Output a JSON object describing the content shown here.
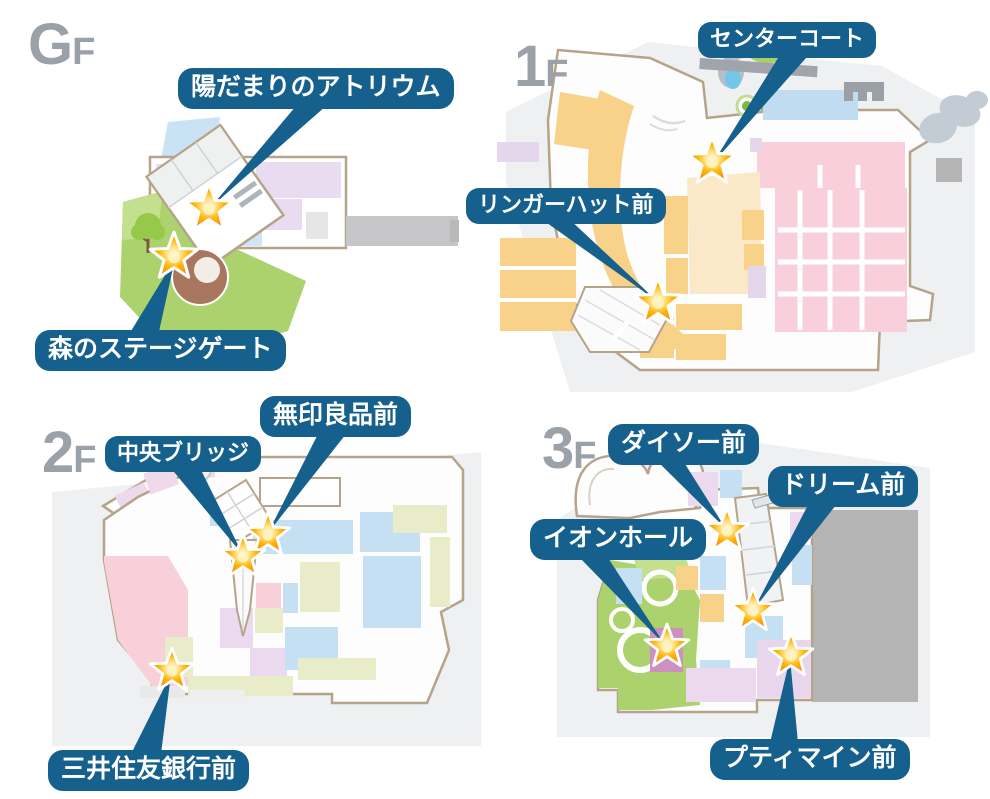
{
  "colors": {
    "callout_bg": "#15608d",
    "callout_text": "#ffffff",
    "star_orange": "#f7941d",
    "star_glow": "#fff3c4",
    "floor_label_gray": "#9aa1a8",
    "map_outline_tan": "#b5a48a",
    "backdrop_gray": "#eff0f2",
    "shop_orange": "#f9d28a",
    "shop_pink": "#f8cfda",
    "shop_lavender": "#e9dcf0",
    "shop_blue": "#c5e0f2",
    "shop_olive": "#e9ecc8",
    "park_green": "#abd26d",
    "stage_brown": "#a9775f"
  },
  "floors": {
    "gf": {
      "label_big": "G",
      "label_small": "F",
      "callouts": [
        {
          "id": "hidamari-atrium",
          "text": "陽だまりのアトリウム"
        },
        {
          "id": "mori-stage-gate",
          "text": "森のステージゲート"
        }
      ]
    },
    "f1": {
      "label_big": "1",
      "label_small": "F",
      "callouts": [
        {
          "id": "center-court",
          "text": "センターコート"
        },
        {
          "id": "ringer-hut-mae",
          "text": "リンガーハット前"
        }
      ]
    },
    "f2": {
      "label_big": "2",
      "label_small": "F",
      "callouts": [
        {
          "id": "muji-mae",
          "text": "無印良品前"
        },
        {
          "id": "chuo-bridge",
          "text": "中央ブリッジ"
        },
        {
          "id": "smbc-mae",
          "text": "三井住友銀行前"
        }
      ]
    },
    "f3": {
      "label_big": "3",
      "label_small": "F",
      "callouts": [
        {
          "id": "daiso-mae",
          "text": "ダイソー前"
        },
        {
          "id": "dream-mae",
          "text": "ドリーム前"
        },
        {
          "id": "aeon-hall",
          "text": "イオンホール"
        },
        {
          "id": "petit-main-mae",
          "text": "プティマイン前"
        }
      ]
    }
  }
}
